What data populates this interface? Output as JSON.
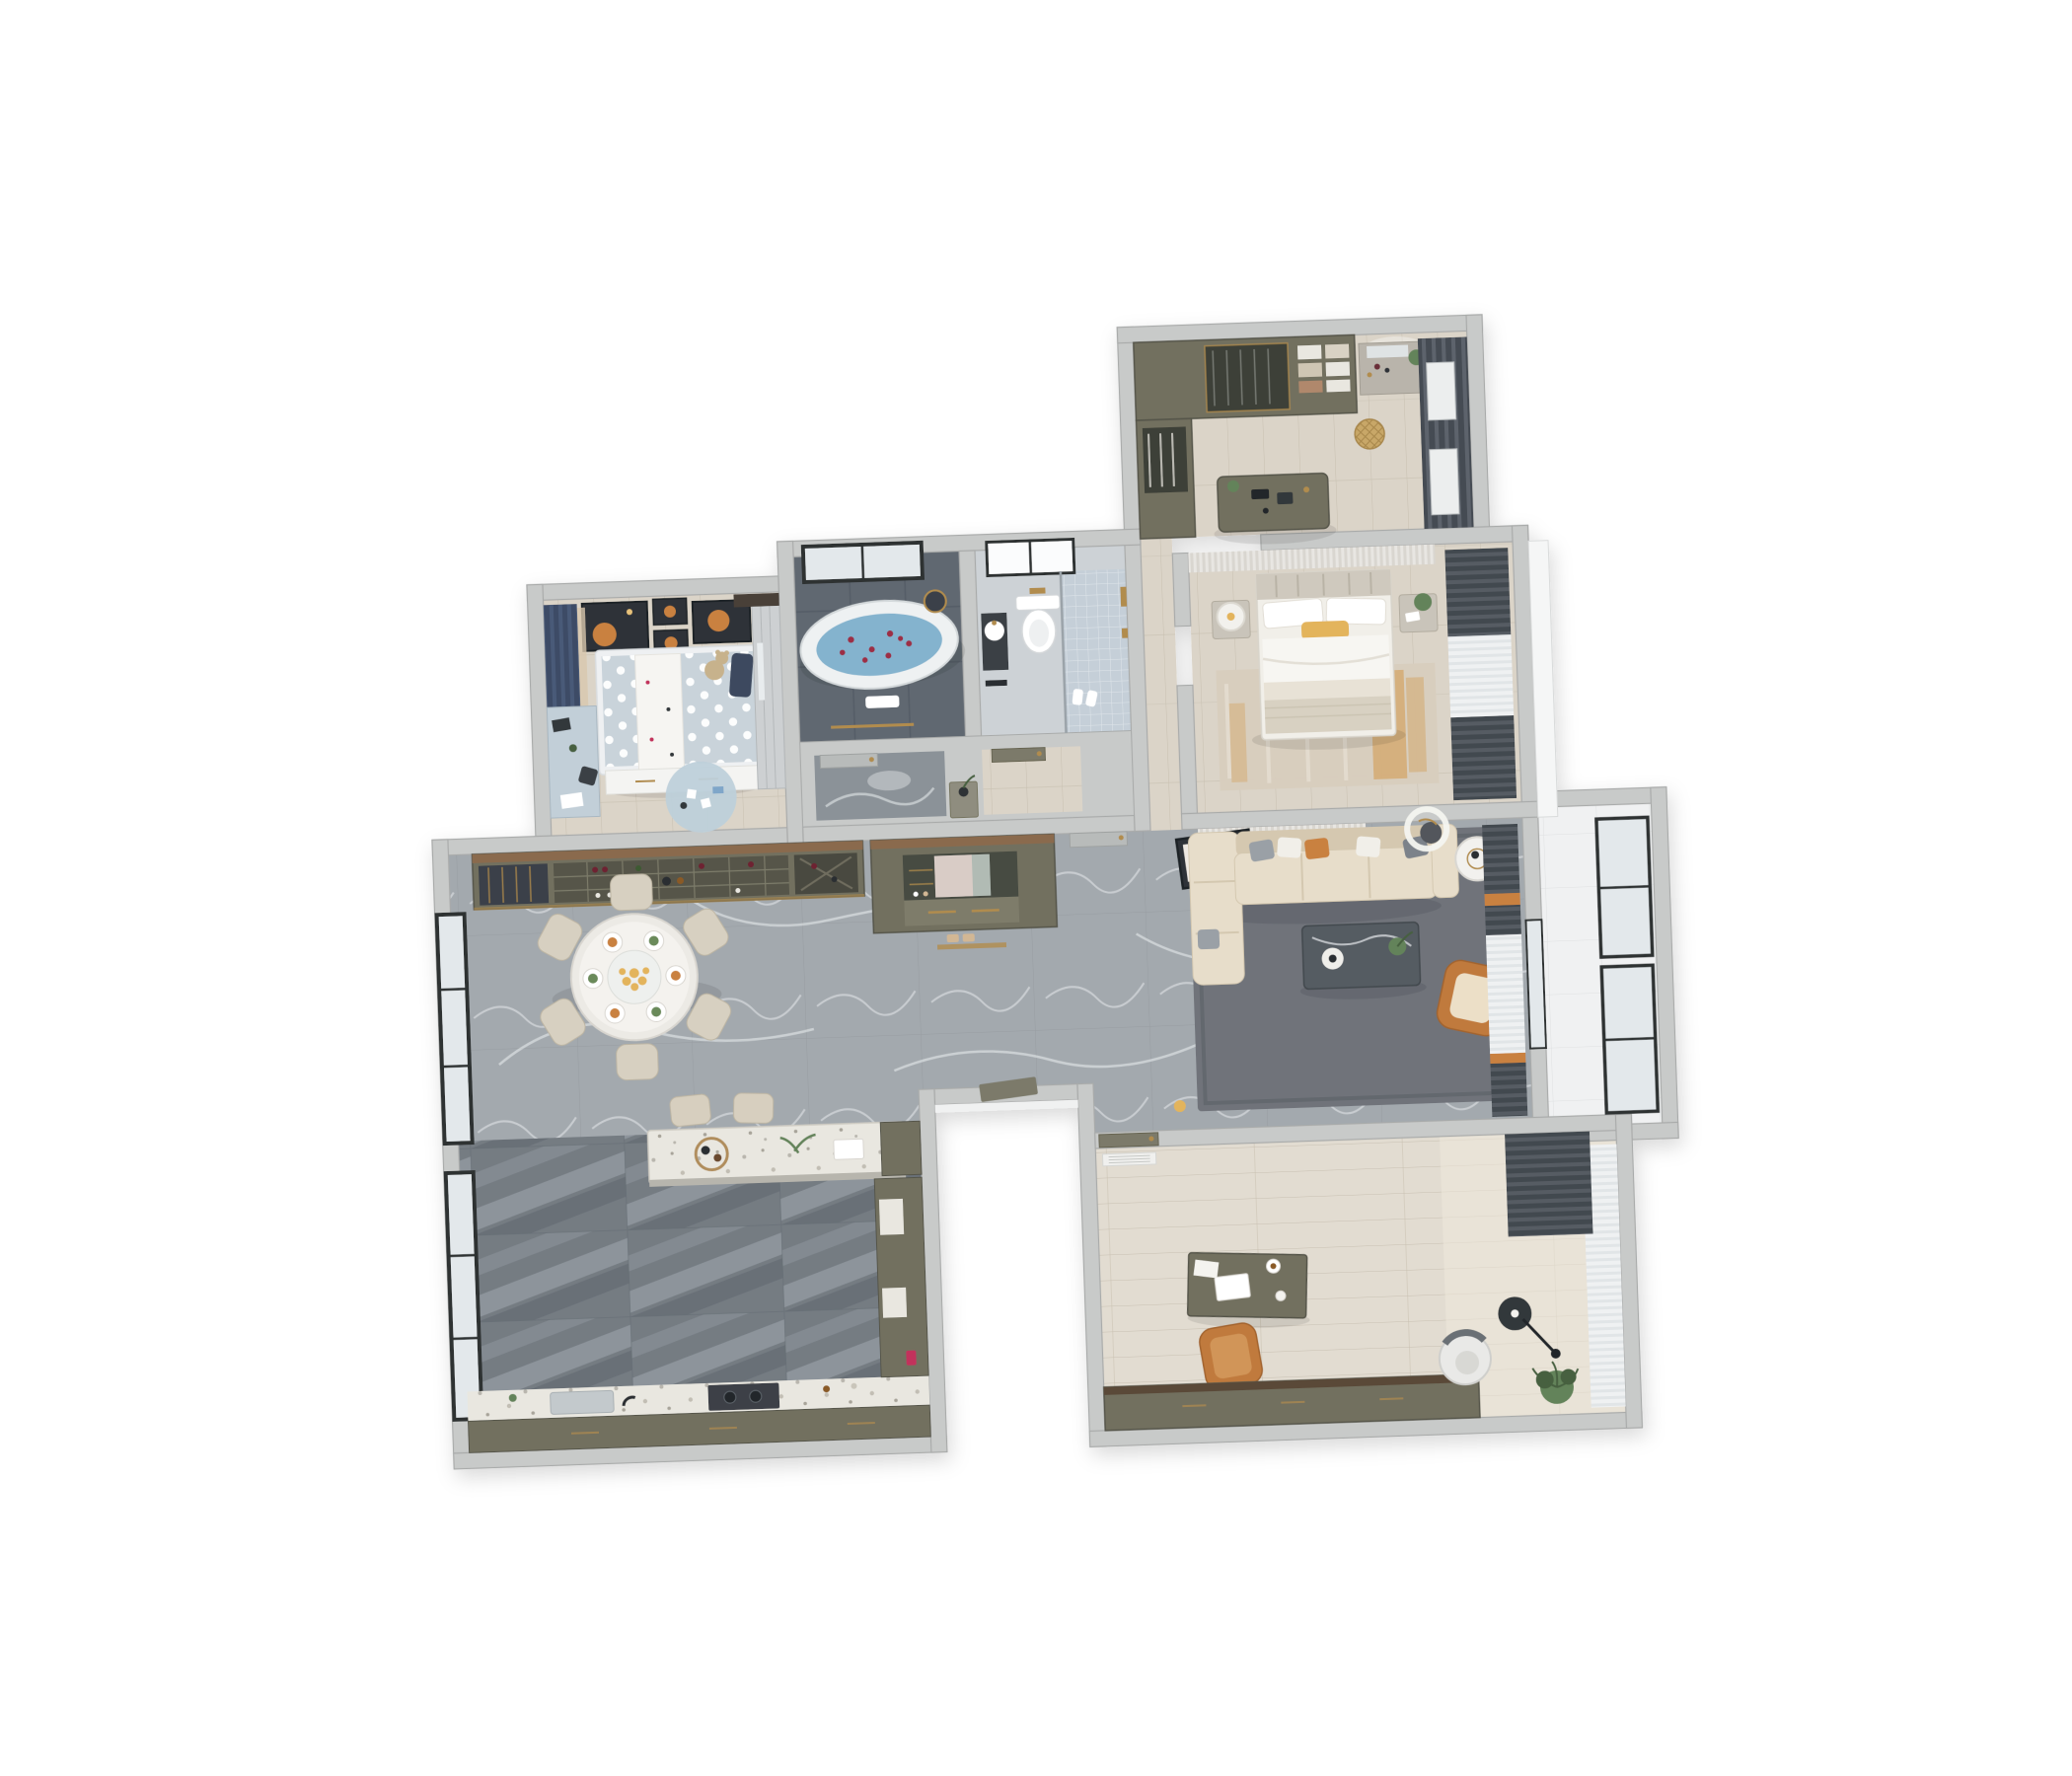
{
  "scene": {
    "type": "3d-apartment-floorplan-render",
    "view": "top-down dollhouse",
    "background": "#ffffff",
    "rotation_deg": -2
  },
  "palette": {
    "void": "#ffffff",
    "wall": "#c8cac9",
    "wallEdge": "#a9abaa",
    "jamb": "#f0f1f1",
    "wood": "#dbd4c8",
    "woodLine": "#c7bfb0",
    "woodLight": "#e2dcd1",
    "woodSun": "#efe9dd",
    "marble": "#a3a9ae",
    "marbleLine": "#8d9499",
    "marbleVein": "#edf0f2",
    "kitchenTile": "#747b82",
    "kitchenBand": "#a6adb3",
    "kitchenShade": "#585f66",
    "slate": "#606871",
    "slateLine": "#515963",
    "bathLight": "#cdd2d6",
    "mosaic": "#c5cfd8",
    "balcony": "#f0f1f2",
    "frameBlack": "#2d3033",
    "glass": "#e3e8eb",
    "olive": "#72705f",
    "oliveDark": "#55544a",
    "woodTop": "#8a6b4e",
    "navy": "#3d4c66",
    "navyStripe": "#4a5a78",
    "curtain": "#565c64",
    "curtainDark": "#42484f",
    "sheer": "#eef0f1",
    "sheerLine": "#e1e5e7",
    "orange": "#c9813f",
    "armchair": "#c07a3c",
    "cushion": "#ecdfc7",
    "sofa": "#e7ddca",
    "sofaShade": "#d5c8b0",
    "rugLiving": "#6f737a",
    "rugLivingEdge": "#5f636a",
    "rugMaster": "#d8cdbe",
    "rugOrange": "#d2913e",
    "rugKid": "#bed0da",
    "kidBed": "#c9d3da",
    "white": "#ffffff",
    "offWhite": "#f3f2ef",
    "bedWhite": "#f1efe9",
    "blanket": "#d8d1c2",
    "yellow": "#e3b45c",
    "gold": "#b18c4d",
    "water": "#84b3ce",
    "petal": "#9c2f44",
    "coffee": "#555b62",
    "art": "#2f3337",
    "terrazzo": "#e9e7e0",
    "stool": "#d7cfbf",
    "chairBeige": "#d7d0c1",
    "plant": "#64835a",
    "plantDark": "#46603f",
    "teddy": "#c7b28c",
    "toyBlue": "#7fa6c9",
    "toyRed": "#c2335c",
    "doorGray": "#b8bbba",
    "doorOlive": "#7c7a6a",
    "niche": "#474b42",
    "mirror": "#d9ccc6",
    "slipper": "#d2b794"
  },
  "rooms": [
    {
      "id": "walk-in-closet",
      "furniture": [
        "wardrobe-doors",
        "wardrobe-glass",
        "open-shelves",
        "dressing-table",
        "mirror",
        "plants",
        "rattan-basket",
        "island-dresser",
        "window-blinds"
      ]
    },
    {
      "id": "master-bedroom",
      "furniture": [
        "headboard-wall",
        "double-bed",
        "pillows",
        "accent-pillow",
        "nightstand-left",
        "table-lamp",
        "nightstand-right",
        "plant",
        "distressed-rug",
        "curtains",
        "window-bay"
      ]
    },
    {
      "id": "master-bathroom",
      "furniture": [
        "freestanding-bathtub",
        "rose-petals",
        "window",
        "rain-shower",
        "towel-rail"
      ]
    },
    {
      "id": "guest-bathroom",
      "furniture": [
        "wall-hung-toilet",
        "vanity-basin",
        "walk-in-shower",
        "mosaic-floor",
        "window",
        "slippers",
        "gold-fixtures"
      ]
    },
    {
      "id": "kids-bedroom",
      "furniture": [
        "wall-art-frames",
        "blackout-curtains",
        "polka-dot-bed",
        "bed-runner",
        "teddy-bear",
        "under-bed-drawers",
        "study-desk",
        "wardrobe",
        "play-rug",
        "toys"
      ]
    },
    {
      "id": "dining-room",
      "furniture": [
        "wine-cabinet",
        "floor-windows",
        "round-dining-table",
        "dining-chairs",
        "place-settings",
        "flower-centerpiece"
      ]
    },
    {
      "id": "hallway",
      "furniture": [
        "entry-cabinet",
        "mirror-niche",
        "shoe-drawers",
        "interior-door",
        "console-table",
        "gold-threshold"
      ]
    },
    {
      "id": "living-room",
      "furniture": [
        "slat-panel-wall",
        "artwork-panel",
        "sectional-sofa",
        "throw-pillows",
        "side-table",
        "coffee-table",
        "lounge-armchair",
        "area-rug",
        "ceiling-lamp",
        "curtains",
        "toy-duck"
      ]
    },
    {
      "id": "balcony",
      "furniture": [
        "glazed-window-wall"
      ]
    },
    {
      "id": "kitchen",
      "furniture": [
        "island-counter",
        "bar-stools",
        "serving-tray",
        "herb-plant",
        "floor-windows",
        "worktop",
        "sink",
        "cooktop",
        "base-cabinets",
        "side-counter",
        "red-grinder"
      ]
    },
    {
      "id": "study",
      "furniture": [
        "entry-door",
        "ceiling-vent",
        "writing-desk",
        "laptop",
        "desk-chair",
        "credenza",
        "lounge-chair",
        "arc-floor-lamp",
        "potted-plant",
        "sheer-curtains",
        "gray-curtain"
      ]
    },
    {
      "id": "entrance-porch",
      "furniture": [
        "entry-door-leaf"
      ]
    }
  ],
  "counts": {
    "dining_chairs": 6,
    "bar_stools": 2,
    "wall_art_frames": 4,
    "bathrooms": 2,
    "bedrooms": 3
  }
}
